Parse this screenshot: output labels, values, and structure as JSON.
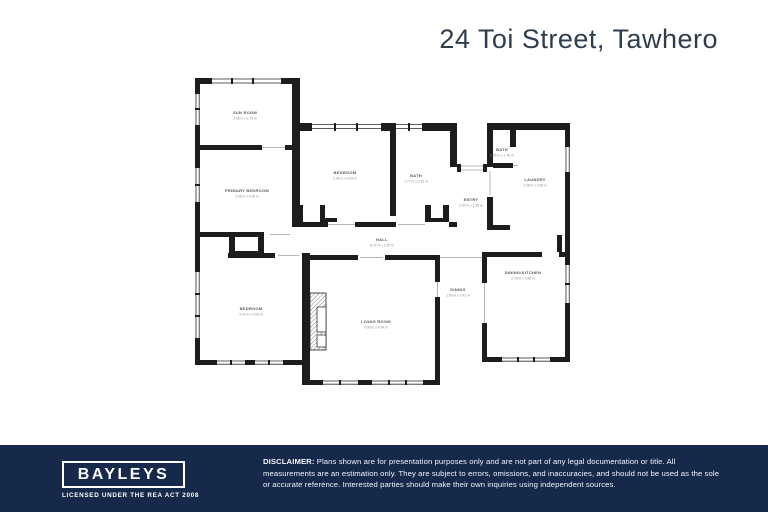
{
  "header": {
    "title": "24 Toi Street, Tawhero"
  },
  "plan": {
    "rooms": [
      {
        "name": "SUN ROOM",
        "dims": "2.96 m x 1.79 m",
        "x": 60,
        "y": 39
      },
      {
        "name": "PRIMARY BEDROOM",
        "dims": "2.96 m x 4.25 m",
        "x": 62,
        "y": 117
      },
      {
        "name": "BEDROOM",
        "dims": "2.96 m x 3.29 m",
        "x": 160,
        "y": 99
      },
      {
        "name": "BATH",
        "dims": "1.77 m x 3.29 m",
        "x": 231,
        "y": 102
      },
      {
        "name": "ENTRY",
        "dims": "0.90 m x 1.98 m",
        "x": 286,
        "y": 126
      },
      {
        "name": "BATH",
        "dims": "0.95 m x 1.45 m",
        "x": 317,
        "y": 76
      },
      {
        "name": "LAUNDRY",
        "dims": "2.38 m x 3.25 m",
        "x": 350,
        "y": 106
      },
      {
        "name": "HALL",
        "dims": "8.47 m x 1.50 m",
        "x": 197,
        "y": 166
      },
      {
        "name": "BEDROOM",
        "dims": "4.04 m x 4.06 m",
        "x": 66,
        "y": 235
      },
      {
        "name": "LIVING ROOM",
        "dims": "4.96 m x 4.84 m",
        "x": 191,
        "y": 248
      },
      {
        "name": "DINING",
        "dims": "1.50 m x 2.41 m",
        "x": 273,
        "y": 216
      },
      {
        "name": "DINING/KITCHEN",
        "dims": "2.79 m x 4.85 m",
        "x": 338,
        "y": 199
      }
    ]
  },
  "footer": {
    "brand": "BAYLEYS",
    "license": "LICENSED UNDER THE REA ACT 2008",
    "disclaimer_label": "DISCLAIMER:",
    "disclaimer_text": " Plans shown are for presentation purposes only and are not part of any legal documentation or title. All measurements are an estimation only. They are subject to errors, omissions, and inaccuracies, and should not be used as the sole or accurate reference. Interested parties should make their own inquiries using independent sources."
  },
  "colors": {
    "navy": "#16294b",
    "wall": "#1d1d1d",
    "label": "#55585c",
    "title": "#2e3e4e"
  }
}
